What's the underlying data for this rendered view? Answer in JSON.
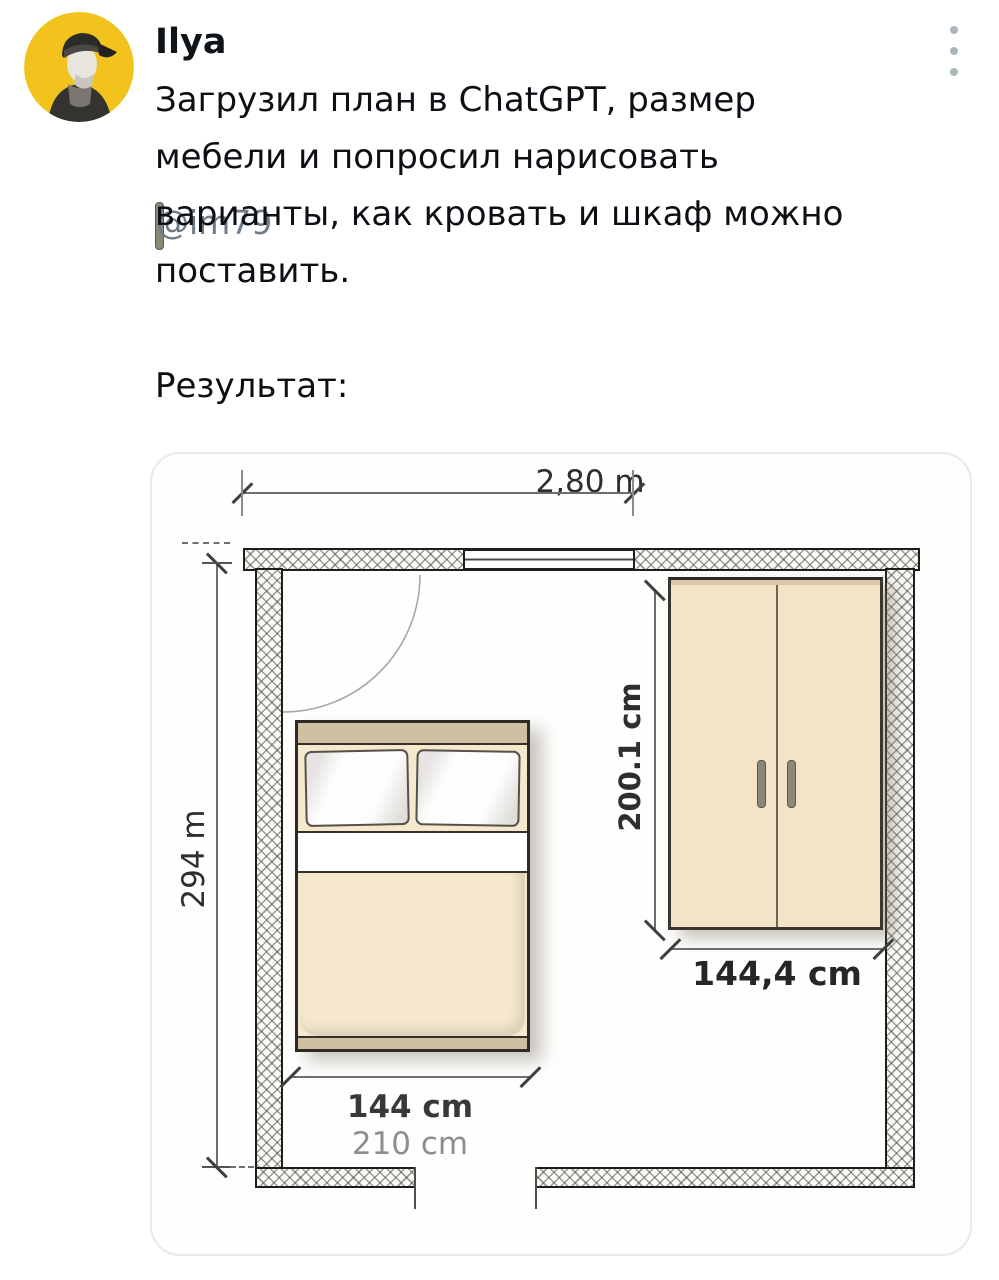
{
  "tweet": {
    "author": "Ilya",
    "handle": "@im79",
    "menu_icon": "kebab-menu-icon",
    "avatar_icon": "man-in-cap-avatar",
    "lines": [
      "Загрузил план в ChatGPT, размер",
      "мебели и попросил нарисовать",
      "варианты, как кровать и шкаф можно",
      "поставить."
    ],
    "result_label": "Результат:"
  },
  "floorplan": {
    "labels": {
      "room_width": "2,80 m",
      "room_height": "294 m",
      "wardrobe_height": "200.1 cm",
      "wardrobe_width": "144,4 cm",
      "bed_width": "144 cm",
      "bed_length": "210 cm"
    },
    "colors": {
      "furniture_fill": "#f3e4c8",
      "headboard_tan": "#cfc0a3",
      "wall_outline": "#1d1d1b",
      "avatar_yellow": "#f2c31d",
      "dim_text_gray": "#8e8e8c"
    }
  }
}
